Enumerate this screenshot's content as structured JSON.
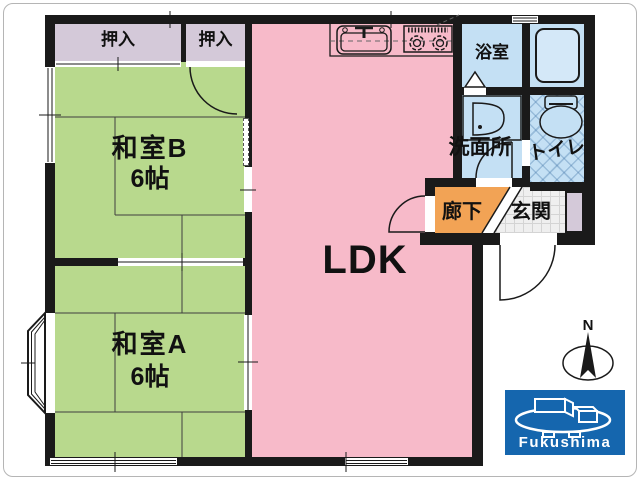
{
  "floor_plan": {
    "closets": [
      {
        "label": "押入"
      },
      {
        "label": "押入"
      }
    ],
    "rooms": {
      "washitsu_b": {
        "name": "和室B",
        "size": "6帖"
      },
      "washitsu_a": {
        "name": "和室A",
        "size": "6帖"
      },
      "ldk": {
        "name": "LDK"
      },
      "bath": {
        "name": "浴室"
      },
      "washroom": {
        "name": "洗面所"
      },
      "toilet": {
        "name": "トイレ"
      },
      "corridor": {
        "name": "廊下"
      },
      "entrance": {
        "name": "玄関"
      }
    },
    "compass": {
      "label": "N"
    },
    "logo": {
      "text": "Fukushima",
      "background": "#1566ae"
    },
    "colors": {
      "tatami_room": "#b8d98d",
      "ldk": "#f7bac9",
      "closet": "#d4c9d9",
      "wet_area": "#c4e0f4",
      "corridor": "#f2a355",
      "wall": "#1a1a1a"
    }
  }
}
